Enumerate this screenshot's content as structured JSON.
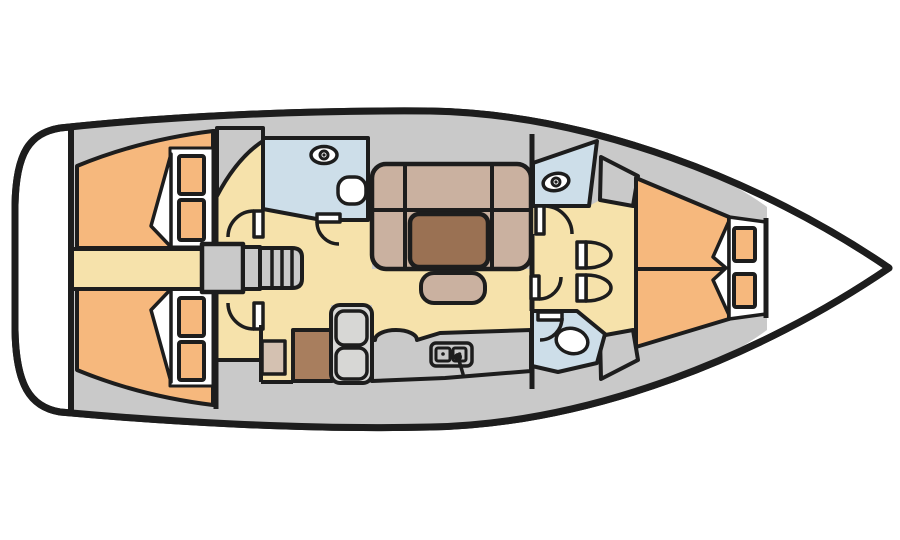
{
  "page": {
    "title": "Sailing yacht interior layout plan (top view, bow to the right)"
  },
  "colors": {
    "outline": "#1d1d1d",
    "hull_white": "#ffffff",
    "deck_gray": "#c9c9c9",
    "floor_cream": "#f6e2ab",
    "berth_orange": "#f6b87d",
    "wet_area_blue": "#cddee9",
    "upholstery_tan": "#cab1a0",
    "table_brown": "#9a7153",
    "chart_table_brown": "#a87e5e",
    "appliance_gray": "#d7d7d5",
    "seat_tan": "#d4c1b1"
  },
  "layout": {
    "orientation": "bow-right",
    "areas": [
      {
        "id": "transom-platform",
        "label": "Transom platform"
      },
      {
        "id": "aft-cabin-port",
        "label": "Aft double cabin (upper)",
        "pillows": 2
      },
      {
        "id": "aft-cabin-starboard",
        "label": "Aft double cabin (lower)",
        "pillows": 2
      },
      {
        "id": "companionway",
        "label": "Companionway steps over engine box",
        "treads": 4
      },
      {
        "id": "aft-head",
        "label": "Aft head with basin and WC"
      },
      {
        "id": "saloon",
        "label": "Saloon with U-settee, table and bench"
      },
      {
        "id": "nav-station",
        "label": "Chart table with seat"
      },
      {
        "id": "galley",
        "label": "Galley with stove, counter and twin sink",
        "sink_basins": 2,
        "stove_sections": 2
      },
      {
        "id": "forward-head",
        "label": "Forward head with basin"
      },
      {
        "id": "forward-wc",
        "label": "Forward WC / shower"
      },
      {
        "id": "forward-cabin",
        "label": "Forward V-berth cabin",
        "pillows": 2
      },
      {
        "id": "bow-locker",
        "label": "Anchor locker"
      }
    ]
  }
}
